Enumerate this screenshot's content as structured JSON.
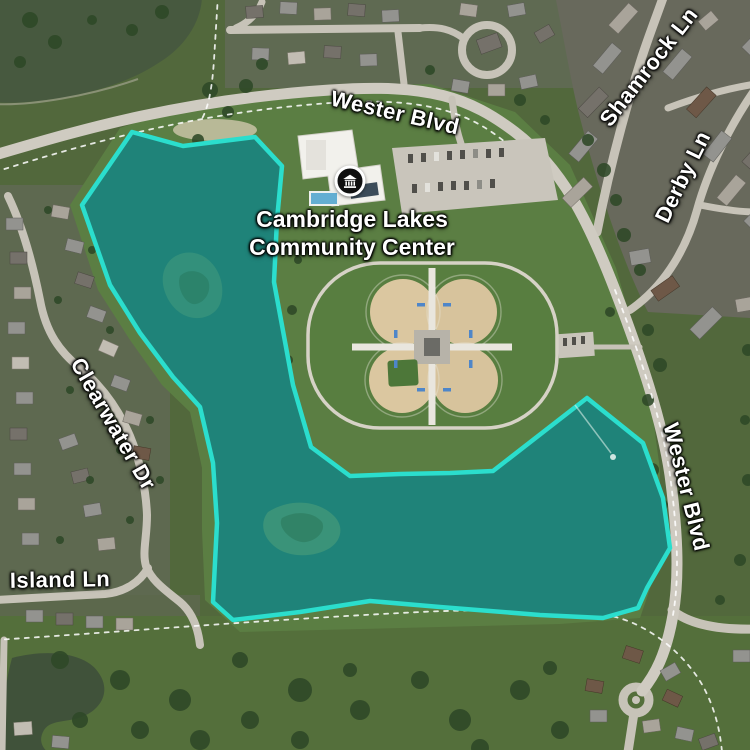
{
  "map": {
    "view": "satellite",
    "labels": {
      "wester_blvd_top": "Wester Blvd",
      "wester_blvd_right": "Wester Blvd",
      "shamrock_ln": "Shamrock Ln",
      "derby_ln": "Derby Ln",
      "clearwater_dr": "Clearwater Dr",
      "island_ln": "Island Ln"
    },
    "poi": {
      "name_line1": "Cambridge Lakes",
      "name_line2": "Community Center",
      "icon": "landmark-icon"
    },
    "highlight": {
      "description": "selected lake area",
      "stroke": "#2bdecd",
      "fill": "#1f8379",
      "points": "132,132 183,146 255,137 282,166 277,220 274,282 293,385 311,447 350,476 400,474 450,473 493,471 587,398 643,443 663,498 670,548 647,588 638,608 603,618 540,615 440,607 370,601 300,612 233,620 213,602 217,523 213,463 200,407 173,377 140,333 110,285 82,205"
    }
  }
}
